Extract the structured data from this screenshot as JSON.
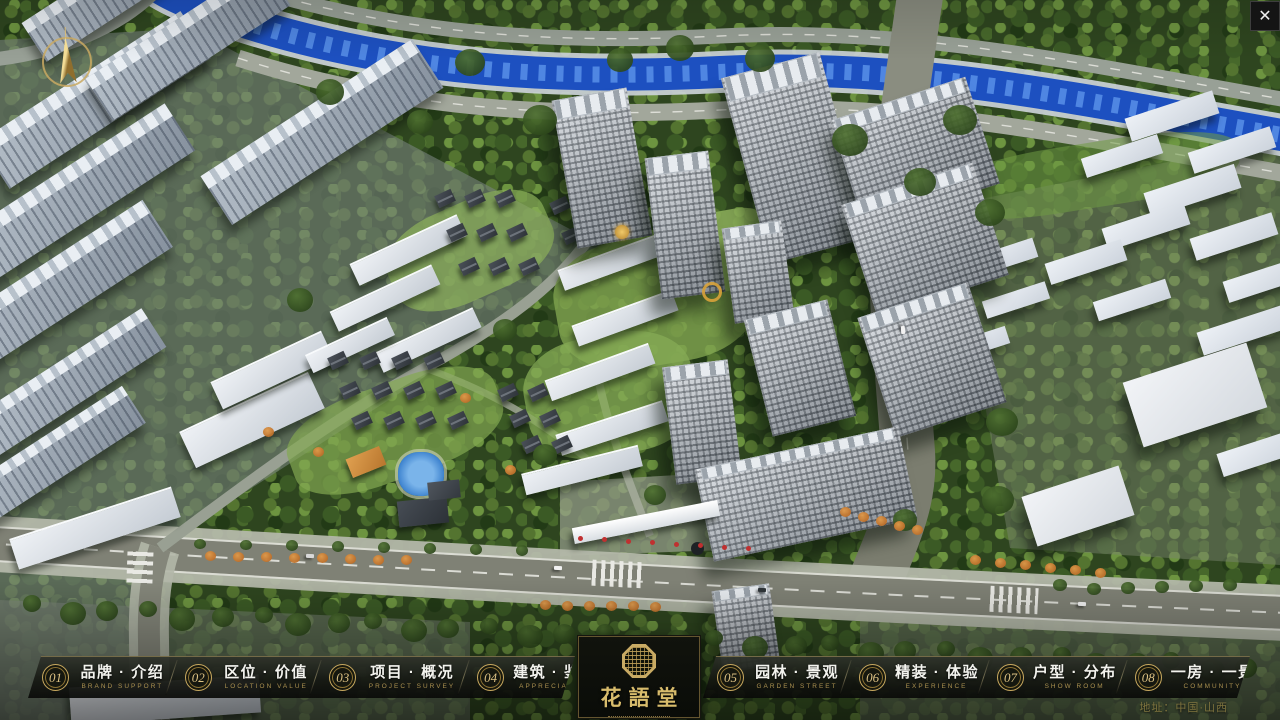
{
  "nav": {
    "items": [
      {
        "num": "01",
        "label": "品牌 · 介绍",
        "caption": "BRAND SUPPORT"
      },
      {
        "num": "02",
        "label": "区位 · 价值",
        "caption": "LOCATION VALUE"
      },
      {
        "num": "03",
        "label": "项目 · 概况",
        "caption": "PROJECT SURVEY"
      },
      {
        "num": "04",
        "label": "建筑 · 鉴赏",
        "caption": "APPRECIATION"
      },
      {
        "num": "05",
        "label": "园林 · 景观",
        "caption": "GARDEN STREET"
      },
      {
        "num": "06",
        "label": "精装 · 体验",
        "caption": "EXPERIENCE"
      },
      {
        "num": "07",
        "label": "户型 · 分布",
        "caption": "SHOW ROOM"
      },
      {
        "num": "08",
        "label": "一房 · 一景",
        "caption": "COMMUNITY"
      }
    ]
  },
  "logo": {
    "title": "花語堂"
  },
  "footer": {
    "address": "地址：中国·山西"
  },
  "window": {
    "close_symbol": "✕"
  }
}
